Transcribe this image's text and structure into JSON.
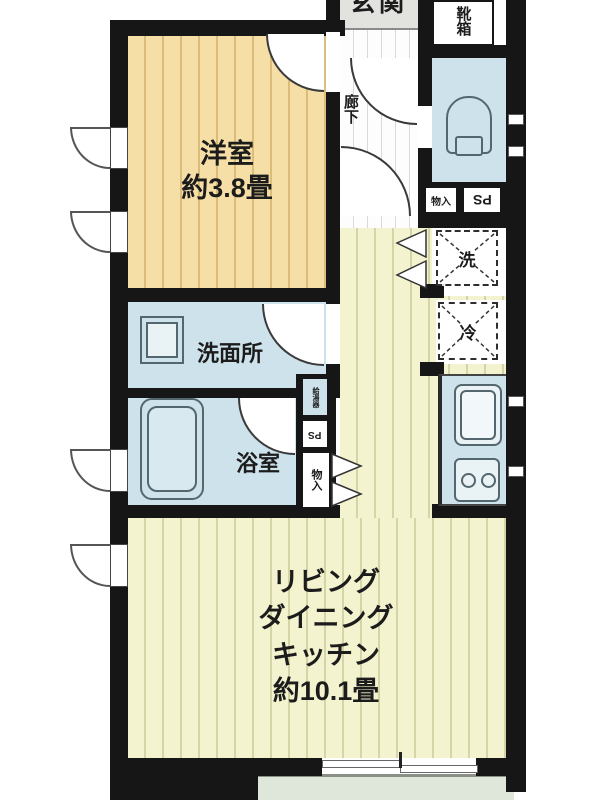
{
  "plan": {
    "western_room": {
      "name": "洋室",
      "size": "約3.8畳"
    },
    "ldk": {
      "line1": "リビング",
      "line2": "ダイニング",
      "line3": "キッチン",
      "size": "約10.1畳"
    },
    "washroom": {
      "name": "洗面所"
    },
    "bathroom": {
      "name": "浴室"
    },
    "hallway": {
      "name": "廊下"
    },
    "entrance": {
      "name": "玄関"
    },
    "shoe_box": {
      "name": "靴箱"
    },
    "storage_upper": {
      "name": "物入"
    },
    "ps_upper": {
      "name": "PS"
    },
    "water_heater": {
      "name": "給湯器"
    },
    "ps_mid": {
      "name": "PS"
    },
    "storage_mid": {
      "name": "物入"
    },
    "washer_symbol": {
      "name": "洗"
    },
    "fridge_symbol": {
      "name": "冷"
    },
    "colors": {
      "wall": "#161616",
      "tatami_room": "#f6dfa6",
      "ldk_floor": "#f3f3cf",
      "wet_room": "#cde2ea",
      "entrance_floor": "#e2e3df",
      "balcony_floor": "#dfe7db"
    }
  }
}
